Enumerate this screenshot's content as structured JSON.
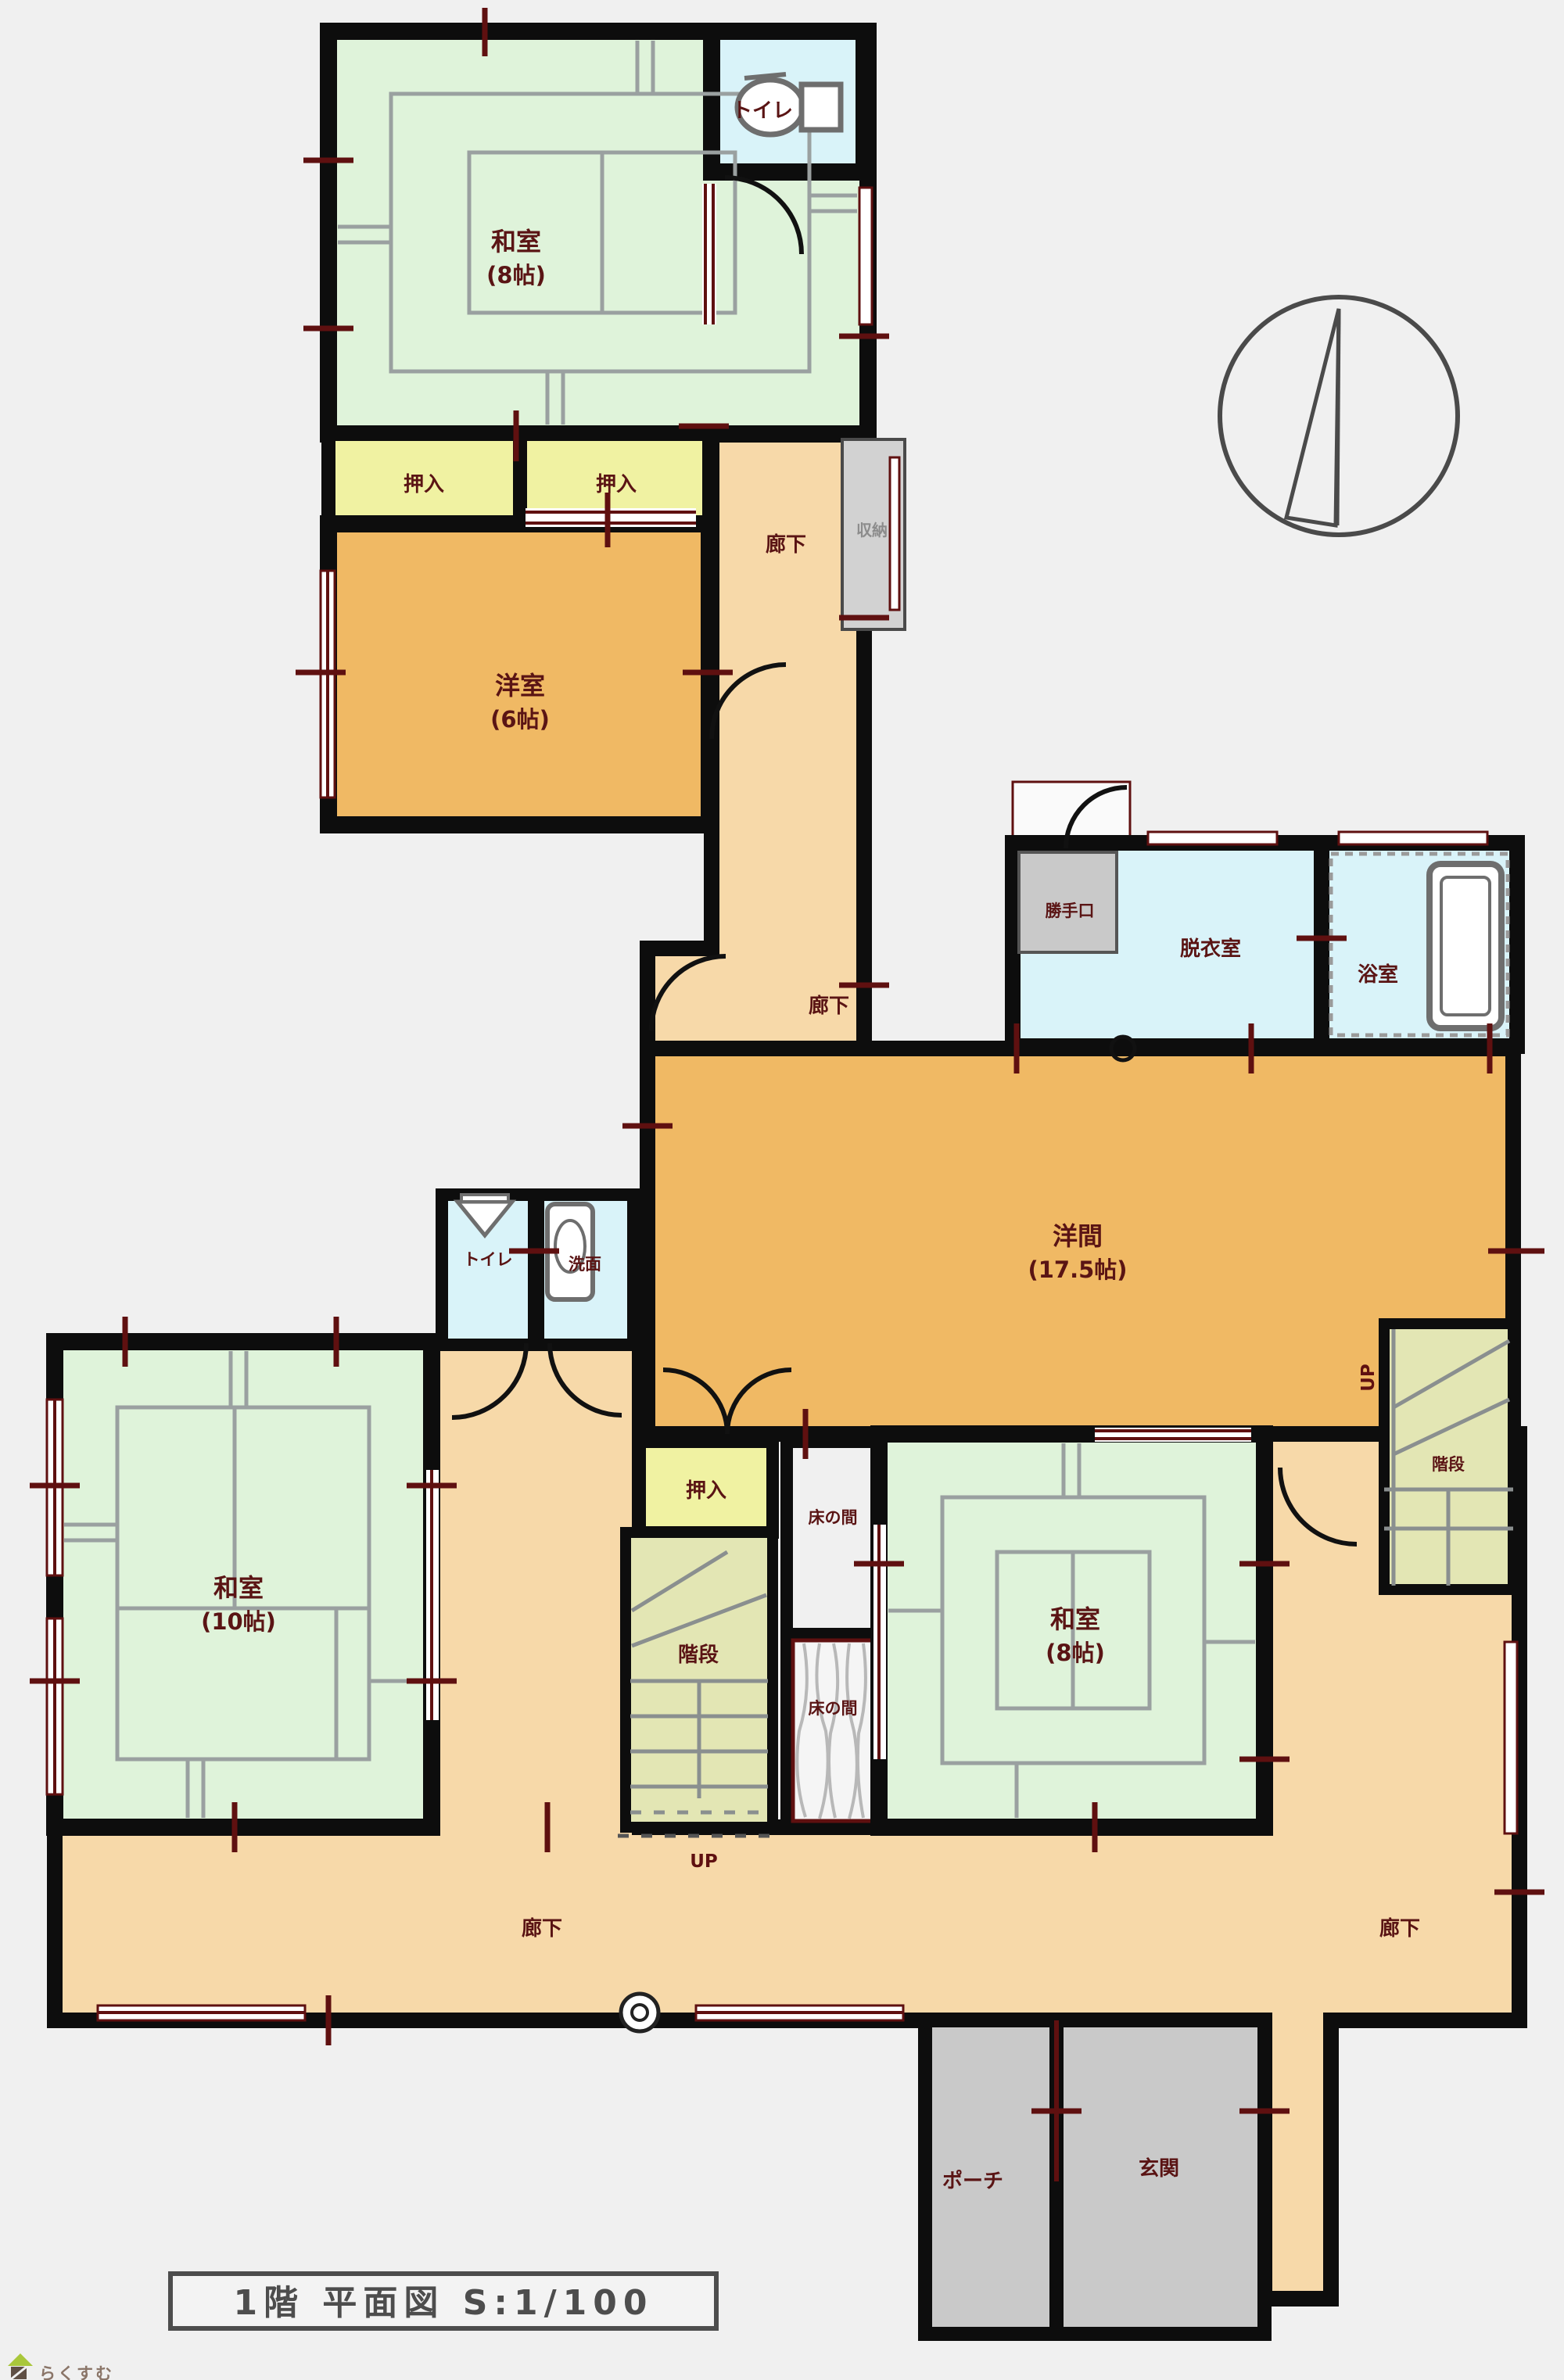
{
  "meta": {
    "title": "1階 平面図 S:1/100",
    "watermark": "らくすむ"
  },
  "rooms": {
    "washitsu_top": {
      "name": "和室",
      "size": "(8帖)"
    },
    "toilet_top": {
      "name": "トイレ"
    },
    "hallway_top": {
      "name": "廊下"
    },
    "closet_storage": {
      "name": "収納"
    },
    "oshiire_left": {
      "name": "押入"
    },
    "oshiire_right": {
      "name": "押入"
    },
    "youshitsu": {
      "name": "洋室",
      "size": "(6帖)"
    },
    "hallway_mid": {
      "name": "廊下"
    },
    "katteguchi": {
      "name": "勝手口"
    },
    "datsuishitsu": {
      "name": "脱衣室"
    },
    "yokushitsu": {
      "name": "浴室"
    },
    "youma": {
      "name": "洋間",
      "size": "(17.5帖)"
    },
    "toilet_mid": {
      "name": "トイレ"
    },
    "senmen": {
      "name": "洗面"
    },
    "washitsu_10": {
      "name": "和室",
      "size": "(10帖)"
    },
    "oshiire_mid": {
      "name": "押入"
    },
    "tokonoma_upper": {
      "name": "床の間"
    },
    "stairs_center": {
      "name": "階段",
      "direction": "UP"
    },
    "tokonoma_lower": {
      "name": "床の間"
    },
    "washitsu_8": {
      "name": "和室",
      "size": "(8帖)"
    },
    "stairs_right": {
      "name": "階段",
      "direction": "UP"
    },
    "hallway_bottom_left": {
      "name": "廊下"
    },
    "hallway_bottom_right": {
      "name": "廊下"
    },
    "porch": {
      "name": "ポーチ"
    },
    "genkan": {
      "name": "玄関"
    }
  },
  "colors": {
    "background": "#f0f0f0",
    "tatami_green": "#dff3da",
    "wood_orange": "#f0b964",
    "corridor_tan": "#f7d9a9",
    "water_blue": "#d9f3f9",
    "closet_yellow": "#f0f2a2",
    "concrete_gray": "#c9c9c9",
    "stair_green": "#e3e6b4",
    "wall_black": "#0d0d0d",
    "accent_red": "#5f1010"
  }
}
